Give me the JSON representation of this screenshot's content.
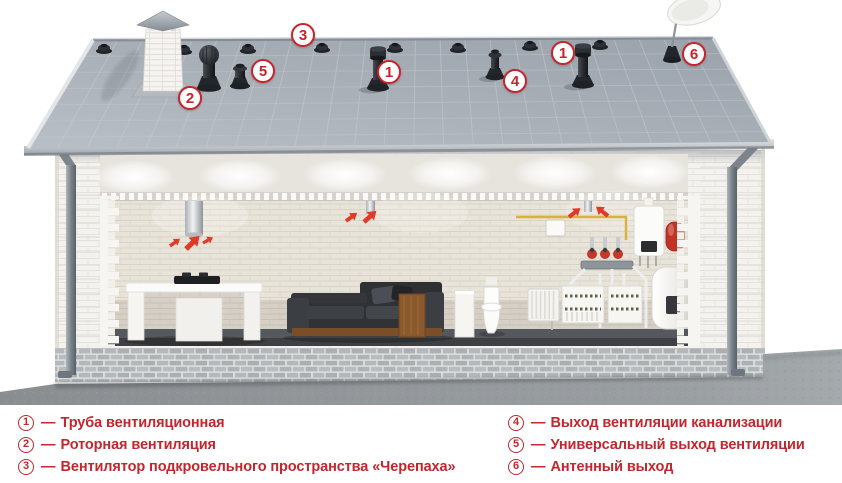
{
  "colors": {
    "legend_red": "#c1272d",
    "marker_red": "#c8232a",
    "arrow_red": "#e03a2a",
    "roof_gray": "#a4abb4"
  },
  "roof_markers": {
    "truba": "1",
    "rotor": "2",
    "turtle": "3",
    "sewer": "4",
    "universal": "5",
    "antenna": "6"
  },
  "scene_components": [
    "roof",
    "chimney",
    "rotary-vent",
    "turtle-vents",
    "ventilation-stack",
    "sewer-vent",
    "universal-vent",
    "antenna-outlet",
    "satellite-dish",
    "kitchen-hood-duct",
    "airflow-arrows",
    "kitchen-island",
    "cooktop",
    "sofa",
    "toilet",
    "radiator",
    "boiler",
    "expansion-tank",
    "water-heater"
  ],
  "legend": {
    "left": [
      {
        "num": "1",
        "dash": "—",
        "label": "Труба вентиляционная"
      },
      {
        "num": "2",
        "dash": "—",
        "label": "Роторная вентиляция"
      },
      {
        "num": "3",
        "dash": "—",
        "label": "Вентилятор подкровельного пространства «Черепаха»"
      }
    ],
    "right": [
      {
        "num": "4",
        "dash": "—",
        "label": "Выход вентиляции канализации"
      },
      {
        "num": "5",
        "dash": "—",
        "label": "Универсальный выход вентиляции"
      },
      {
        "num": "6",
        "dash": "—",
        "label": "Антенный выход"
      }
    ]
  }
}
